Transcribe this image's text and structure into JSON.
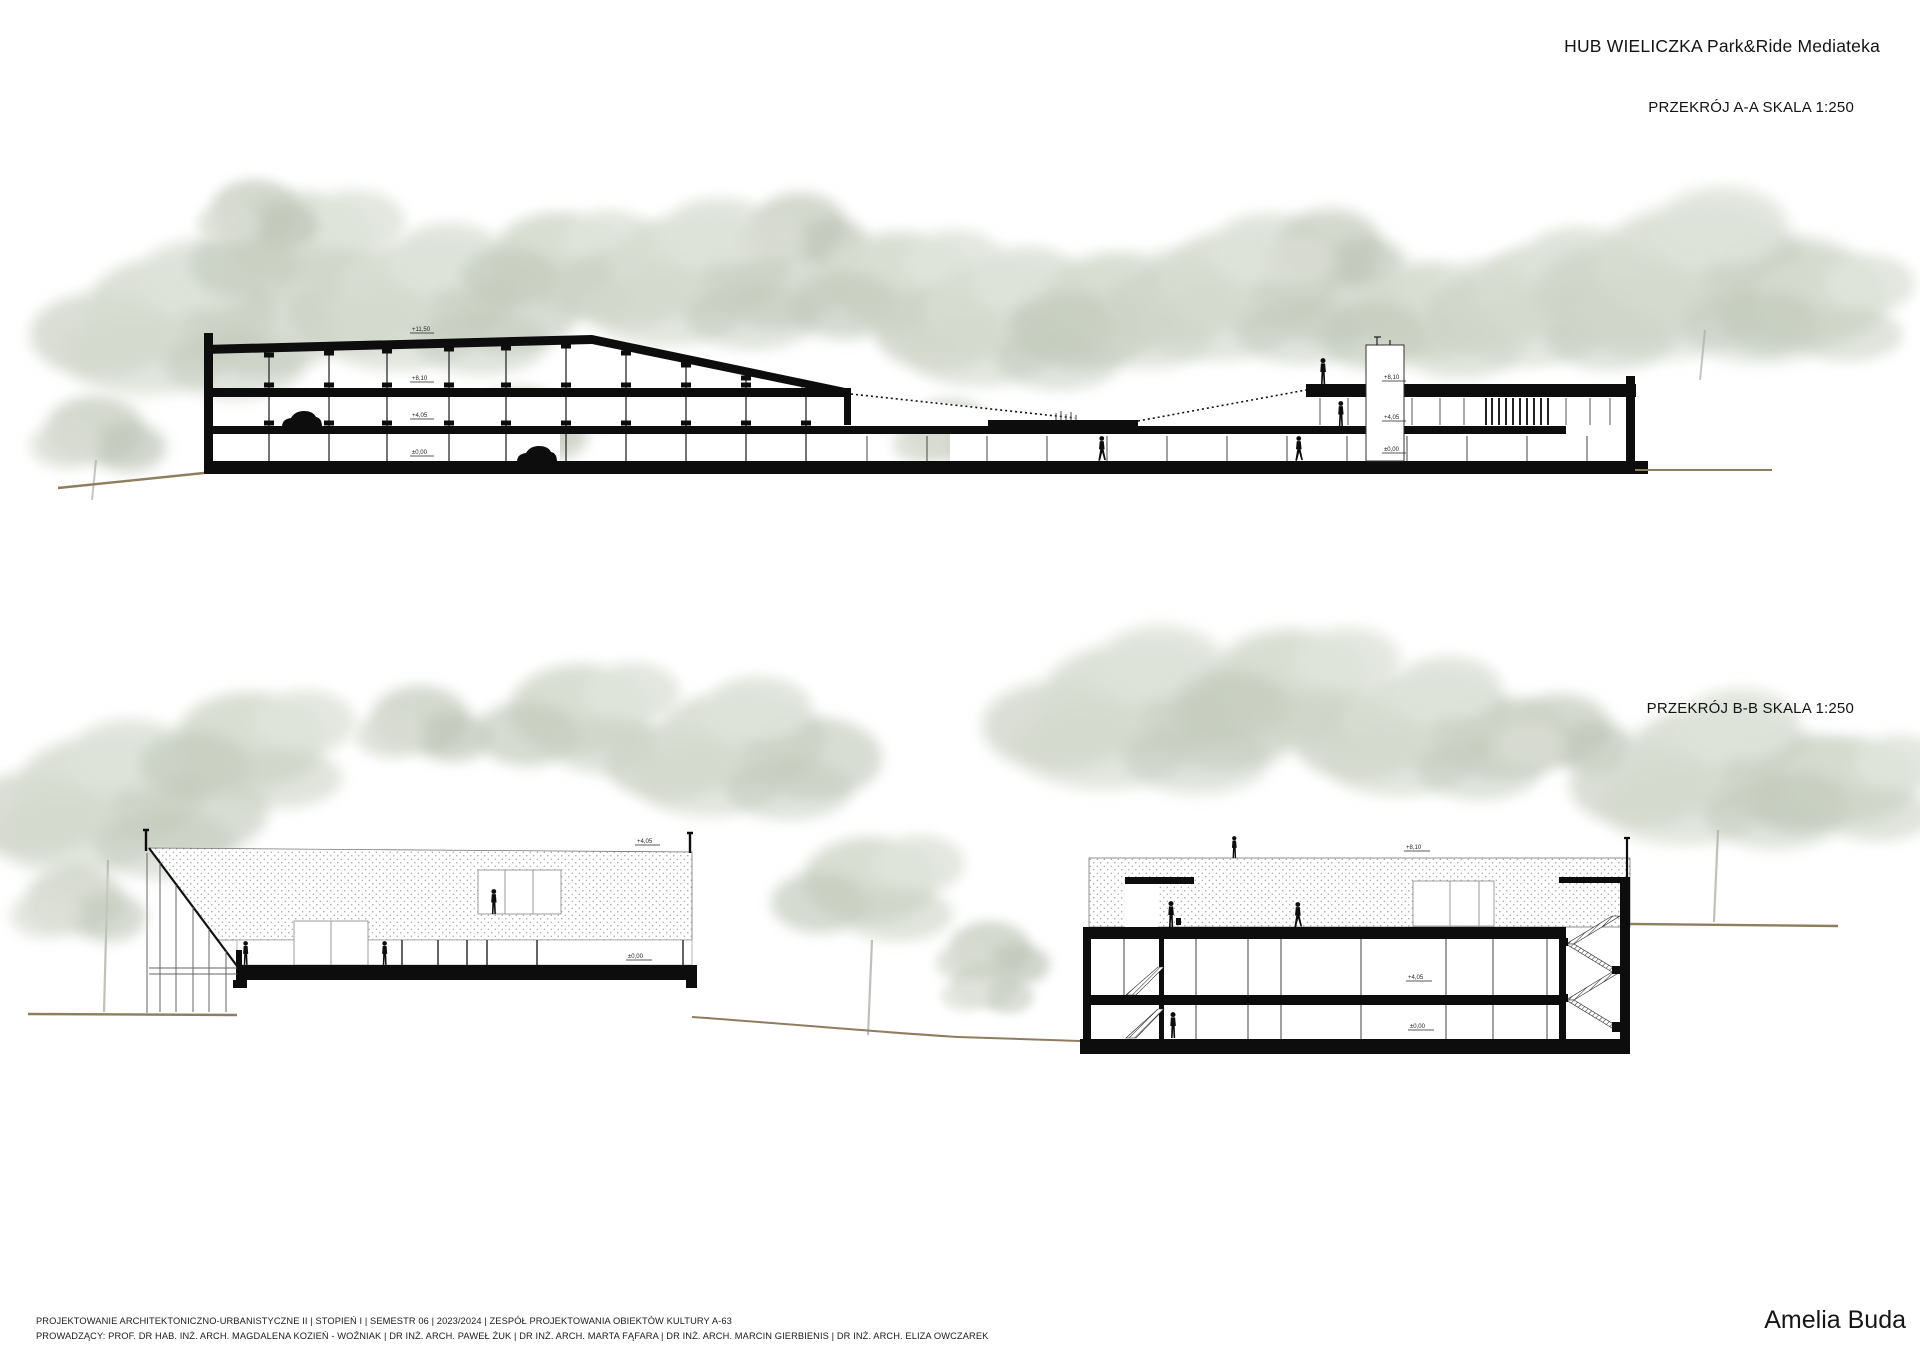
{
  "board": {
    "title": "HUB WIELICZKA Park&Ride Mediateka",
    "author": "Amelia Buda",
    "sections": [
      {
        "id": "a",
        "label": "PRZEKRÓJ A-A SKALA 1:250"
      },
      {
        "id": "b",
        "label": "PRZEKRÓJ B-B SKALA 1:250"
      }
    ],
    "footer": {
      "line1": "PROJEKTOWANIE ARCHITEKTONICZNO-URBANISTYCZNE II | STOPIEŃ I | SEMESTR 06 |  2023/2024 | ZESPÓŁ PROJEKTOWANIA OBIEKTÓW KULTURY A-63",
      "line2": "PROWADZĄCY: PROF. DR HAB. INŻ. ARCH. MAGDALENA KOZIEŃ - WOŹNIAK  | DR INŻ. ARCH. PAWEŁ ŻUK  | DR INŻ. ARCH. MARTA FĄFARA | DR INŻ. ARCH. MARCIN GIERBIENIS | DR INŻ. ARCH. ELIZA OWCZAREK"
    },
    "markers": {
      "a_left": [
        "+11,50",
        "+8,10",
        "+4,05",
        "±0,00"
      ],
      "a_right": [
        "+8,10",
        "+4,05",
        "±0,00"
      ],
      "b_left": [
        "+4,05",
        "±0,00"
      ],
      "b_right": [
        "+8,10",
        "+4,05",
        "±0,00"
      ]
    },
    "colors": {
      "ink": "#0d0d0d",
      "tree_light": "#dfe3da",
      "tree_mid": "#cdd3c7",
      "tree_dark": "#bfc6b9",
      "ground": "#8e7d5f"
    }
  }
}
